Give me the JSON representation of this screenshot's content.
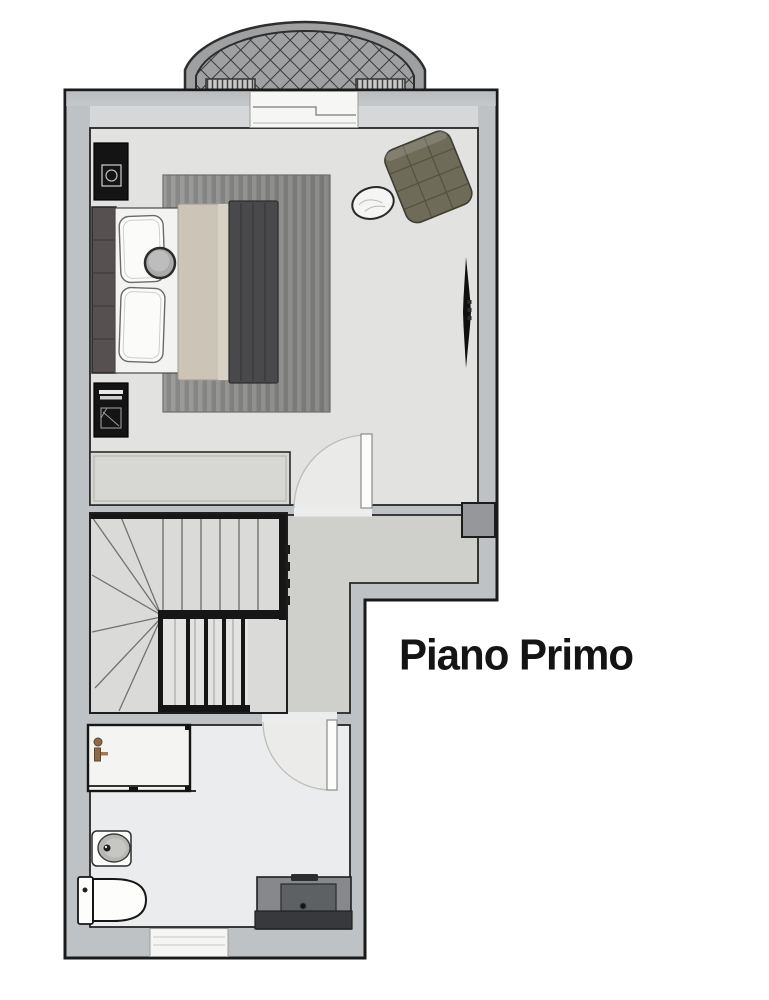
{
  "title": {
    "text": "Piano Primo"
  },
  "palette": {
    "page_bg": "#ffffff",
    "wall": "#bfc2c4",
    "wall_inner_light": "#d5d7d8",
    "wall_outline": "#1a1a1a",
    "wall_box": "#95979a",
    "floor_bedroom": "#e2e2e0",
    "floor_hall": "#cfcfcc",
    "floor_bath": "#ebeced",
    "stair_floor": "#dadad8",
    "stair_dark": "#161616",
    "stair_line": "#72726f",
    "rug": "#8b8b89",
    "headboard": "#565050",
    "bed_sheet": "#f3f3f1",
    "pillow": "#fbfbfa",
    "blanket": "#ccc4b7",
    "blanket_light": "#d8d1c6",
    "throw": "#49494b",
    "round_cushion": "#ababab",
    "nightstand": "#141414",
    "armchair": "#6e6b59",
    "armchair_line": "#56533f",
    "side_table": "#f5f5f3",
    "cabinet": "#d7d7d4",
    "door_leaf": "#fcfcfb",
    "door_swing": "#ebebe9",
    "lattice_line": "#3a3a3a",
    "arch_band": "#9fa0a1",
    "planter": "#c9c9c9",
    "shower_floor": "#f4f4f3",
    "fixture_bronze": "#8d6a4c",
    "sink_bowl": "#b7b7b4",
    "ceramic": "#fdfdfc",
    "vanity_top": "#86888b",
    "vanity_basin": "#5e6164",
    "vanity_front": "#37393c",
    "tv": "#0f0f0f",
    "title_color": "#141414"
  },
  "items": [
    "balcony-trellis",
    "balcony-planter",
    "balcony-door",
    "bedroom",
    "double-bed",
    "headboard",
    "pillow",
    "round-cushion",
    "blanket",
    "throw",
    "rug",
    "nightstand",
    "dresser",
    "armchair",
    "side-table",
    "wall-tv",
    "wardrobe-cabinet",
    "door-swing",
    "winder-staircase",
    "stair-hall",
    "bathroom",
    "shower",
    "shower-fixture",
    "washbasin",
    "toilet",
    "vanity-unit",
    "window"
  ]
}
